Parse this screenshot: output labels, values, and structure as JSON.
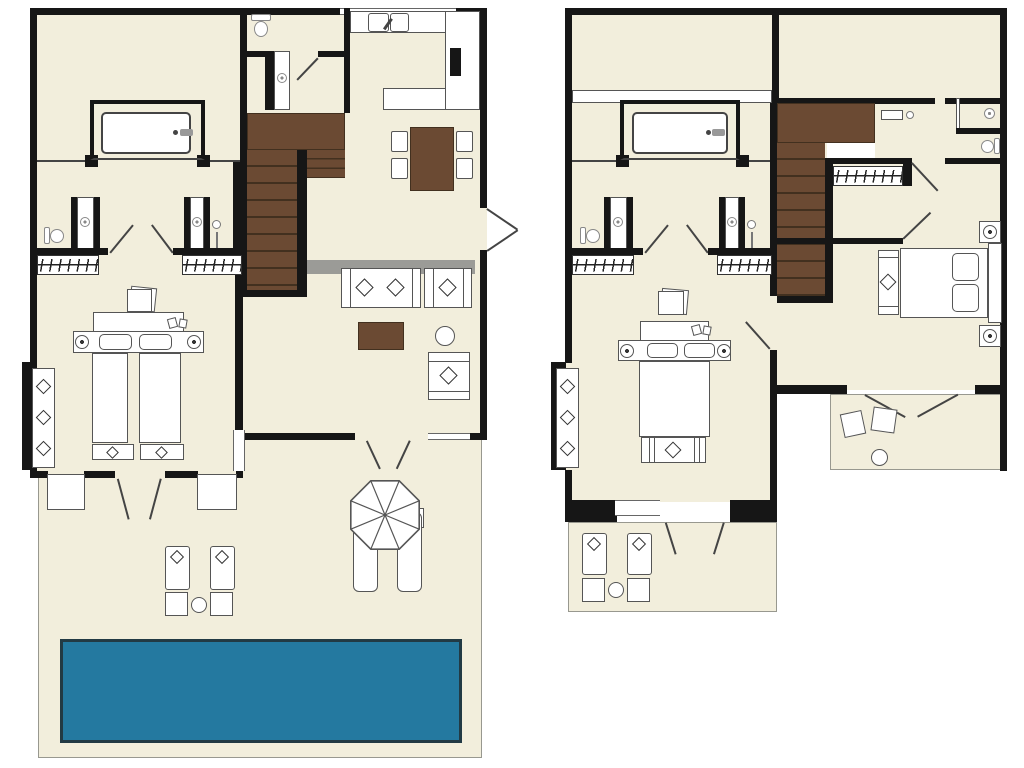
{
  "document": {
    "type": "architectural-floor-plan",
    "subject": "two-storey villa with swimming pool",
    "visible_text": [],
    "floor_count": 2
  },
  "palette": {
    "background": "#FFFFFF",
    "interior": "#F2EEDC",
    "wall": "#161616",
    "wood": "#6B4A33",
    "wood-dark": "#42301F",
    "pool-water": "#2479A0",
    "pool-border": "#223A44",
    "outline": "#555555",
    "outline-light": "#98988F",
    "console-gray": "#9B9B97"
  },
  "floors": [
    {
      "id": "ground-floor",
      "position": "left",
      "rooms": [
        "bedroom-with-bathtub-alcove",
        "wc",
        "shower-room",
        "kitchen",
        "dining-area",
        "living-area",
        "hallway-with-wardrobes",
        "twin-bedroom",
        "terrace",
        "pool-deck"
      ],
      "furniture": [
        "bathtub",
        "toilet",
        "shower",
        "kitchen-sink",
        "kitchen-counters",
        "cooker",
        "dining-table",
        "four-chairs",
        "staircase",
        "sofa",
        "armchairs",
        "coffee-table",
        "side-table",
        "twin-beds",
        "headboard",
        "pillows",
        "bedside-lamps",
        "foot-benches",
        "desk-stool",
        "wardrobe-hanger-rails",
        "sun-loungers",
        "side-tables",
        "parasol",
        "swimming-pool"
      ]
    },
    {
      "id": "upper-floor",
      "position": "right",
      "rooms": [
        "upper-landing-rooms",
        "bathtub-alcove",
        "hallway-with-wardrobes",
        "double-bedroom",
        "master-bedroom",
        "bathroom-with-shower-and-wc",
        "balcony",
        "upper-terrace"
      ],
      "furniture": [
        "bathtub",
        "toilet",
        "showers",
        "wash-basin",
        "staircase",
        "wardrobe-hanger-rails",
        "double-bed",
        "master-bed",
        "headboards",
        "pillows",
        "bedside-lamps",
        "foot-benches",
        "desk-stool",
        "balcony-chairs",
        "round-tables",
        "sun-loungers",
        "side-tables"
      ]
    }
  ],
  "symbols": {
    "diamond": "cushion / decor marker",
    "circle-with-dot": "lamp / shower head",
    "zigzag-strip": "wardrobe hanger rail",
    "diagonal-line": "door swing",
    "brown-fill": "wood (stairs, tables)",
    "teal-fill": "pool water"
  }
}
